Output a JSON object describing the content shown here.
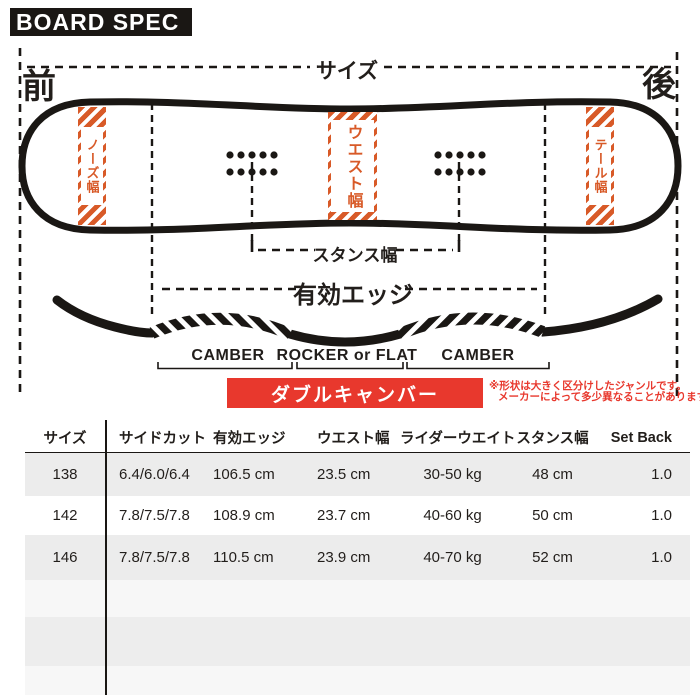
{
  "title": "BOARD SPEC",
  "diagram": {
    "front_label": "前",
    "back_label": "後",
    "size_label": "サイズ",
    "nose_width_label": "ノーズ幅",
    "waist_width_label": "ウエスト幅",
    "tail_width_label": "テール幅",
    "stance_width_label": "スタンス幅",
    "effective_edge_label": "有効エッジ",
    "profile": {
      "camber_left_label": "CAMBER",
      "rocker_label": "ROCKER or FLAT",
      "camber_right_label": "CAMBER",
      "type_label": "ダブルキャンバー"
    },
    "note_line1": "※形状は大きく区分けしたジャンルです。",
    "note_line2": "メーカーによって多少異なることがあります",
    "colors": {
      "accent_orange": "#D85A28",
      "accent_red": "#E8382D",
      "ink": "#1A1714"
    }
  },
  "table": {
    "headers": [
      "サイズ",
      "サイドカット",
      "有効エッジ",
      "ウエスト幅",
      "ライダーウエイト",
      "スタンス幅",
      "Set Back"
    ],
    "rows": [
      [
        "138",
        "6.4/6.0/6.4",
        "106.5 cm",
        "23.5 cm",
        "30-50 kg",
        "48 cm",
        "1.0"
      ],
      [
        "142",
        "7.8/7.5/7.8",
        "108.9 cm",
        "23.7 cm",
        "40-60 kg",
        "50 cm",
        "1.0"
      ],
      [
        "146",
        "7.8/7.5/7.8",
        "110.5 cm",
        "23.9 cm",
        "40-70 kg",
        "52 cm",
        "1.0"
      ]
    ]
  }
}
